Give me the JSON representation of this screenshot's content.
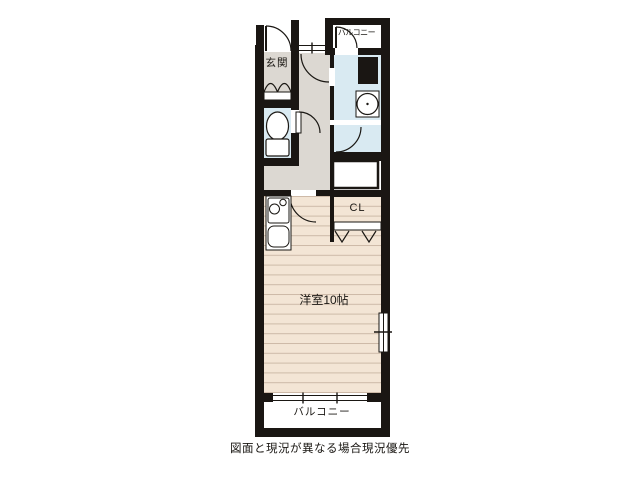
{
  "floorplan": {
    "labels": {
      "entrance": "玄関",
      "balcony_north": "バルコニー",
      "closet": "CL",
      "main_room": "洋室10帖",
      "balcony_south": "バルコニー"
    },
    "footer_note": "図面と現況が異なる場合現況優先",
    "fixtures": [
      "entrance-door",
      "hall-door",
      "toilet",
      "toilet-door",
      "washing-machine",
      "pipe-space",
      "bathroom-door",
      "bathtub",
      "closet-folding-door",
      "stove-burners",
      "kitchen-sink",
      "sliding-window-east",
      "sliding-window-south",
      "balcony-door"
    ],
    "colors": {
      "wall": "#1a1613",
      "hall_floor": "#dcd8d2",
      "room_floor": "#f3e5d5",
      "room_floor_line": "#cdbaa8",
      "wet_area": "#d9eaf2",
      "closet_floor": "#ddd7d0",
      "exterior": "#ffffff"
    }
  }
}
